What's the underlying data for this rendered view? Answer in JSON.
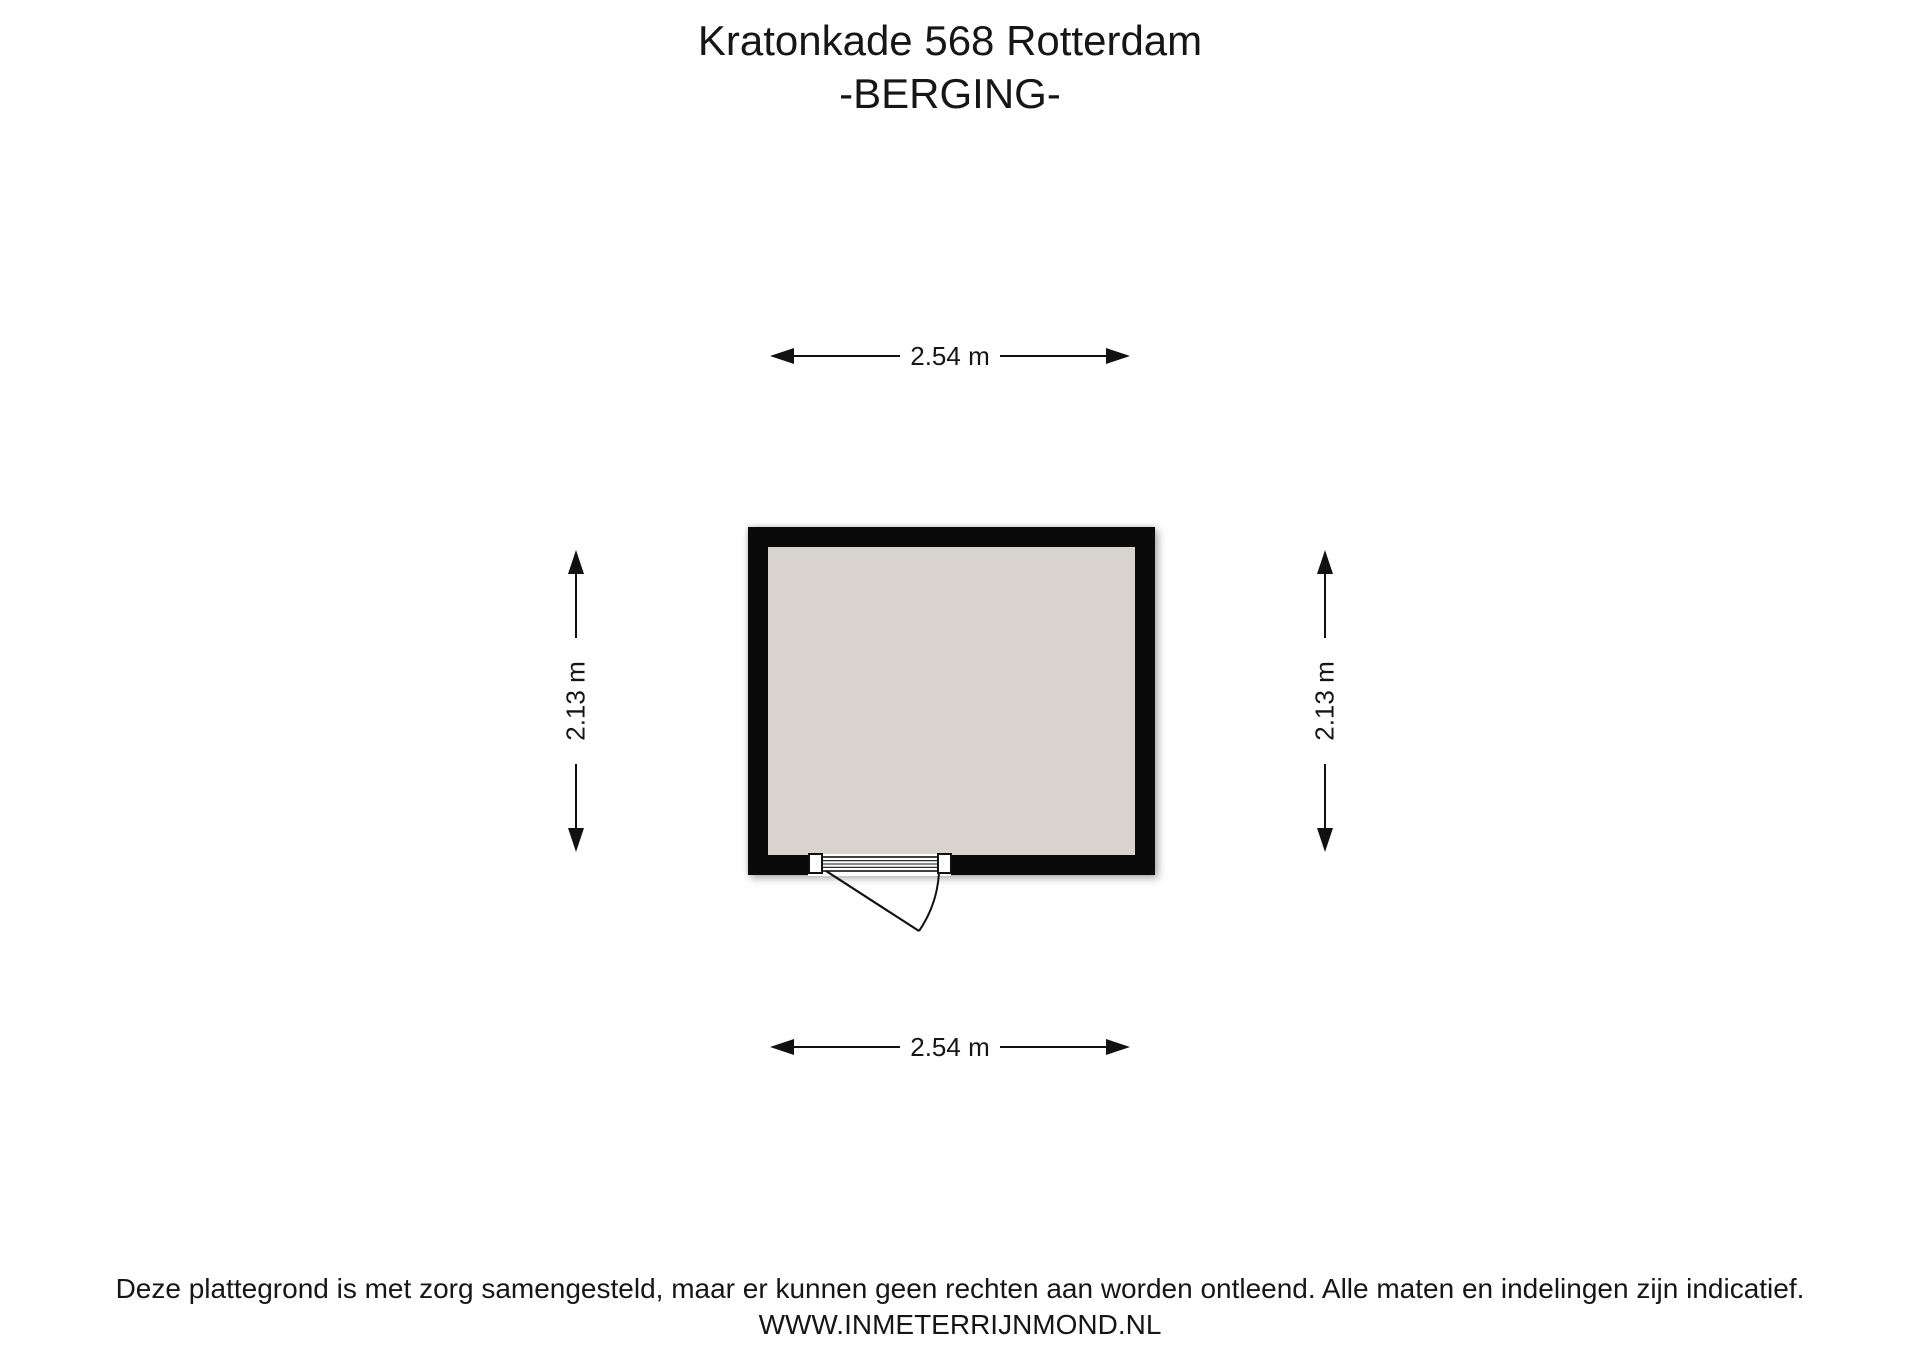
{
  "title": {
    "line1": "Kratonkade 568 Rotterdam",
    "line2": "-BERGING-"
  },
  "dimensions": {
    "top": "2.54 m",
    "bottom": "2.54 m",
    "left": "2.13 m",
    "right": "2.13 m"
  },
  "footer": {
    "disclaimer": "Deze plattegrond is met zorg samengesteld, maar er kunnen geen rechten aan worden ontleend. Alle maten en indelingen zijn indicatief.",
    "website": "WWW.INMETERRIJNMOND.NL"
  },
  "colors": {
    "background": "#ffffff",
    "wall": "#0a0a0a",
    "floor": "#d8d4cd"
  }
}
